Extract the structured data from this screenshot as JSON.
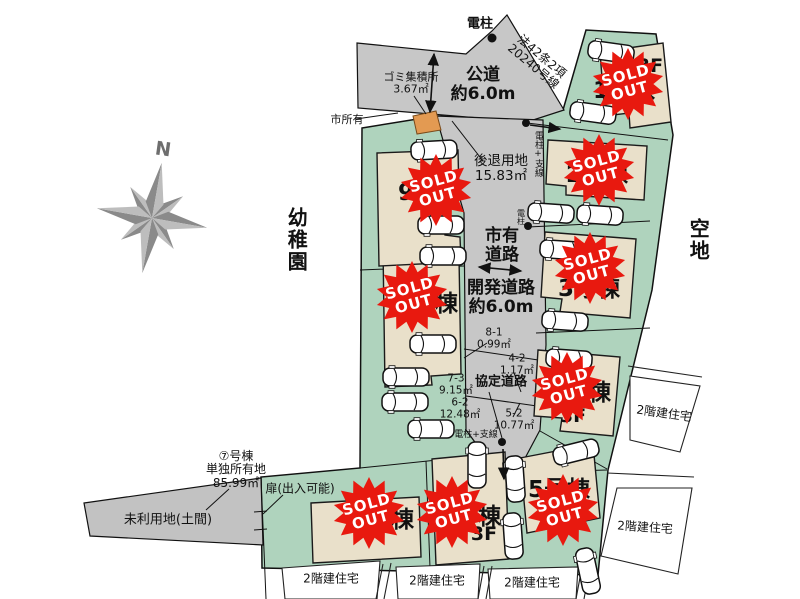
{
  "compass": {
    "north": "N"
  },
  "areas": {
    "kindergarten": "幼稚園",
    "vacant_land": "空地",
    "unused_land": "未利用地(土間)",
    "neighbor_house": "2階建住宅",
    "city_owned": "市所有"
  },
  "roads": {
    "public_road": "公道",
    "public_road_width": "約6.0m",
    "law_line1": "法42条2項",
    "law_line2": "20240号線",
    "city_road_line1": "市有",
    "city_road_line2": "道路",
    "dev_road": "開発道路",
    "dev_road_width": "約6.0m",
    "setback": "後退用地",
    "setback_area": "15.83㎡",
    "agreement_road": "協定道路"
  },
  "features": {
    "utility_pole": "電柱",
    "utility_pole_wire": "電柱+支線",
    "garbage_station": "ゴミ集積所",
    "garbage_area": "3.67㎡",
    "door_note": "扉(出入可能)"
  },
  "sub_parcels": [
    {
      "no": "8-1",
      "area": "0.99㎡"
    },
    {
      "no": "4-2",
      "area": "1.17㎡"
    },
    {
      "no": "7-3",
      "area": "9.15㎡"
    },
    {
      "no": "6-2",
      "area": "12.48㎡"
    },
    {
      "no": "5-2",
      "area": "10.77㎡"
    }
  ],
  "lot7_note": {
    "line1": "⑦号棟",
    "line2": "単独所有地",
    "line3": "85.99㎡"
  },
  "lots": [
    {
      "name": "1号棟",
      "floors": "3F",
      "status": "SOLD OUT"
    },
    {
      "name": "2号棟",
      "floors": "",
      "status": "SOLD OUT"
    },
    {
      "name": "3号棟",
      "floors": "",
      "status": "SOLD OUT"
    },
    {
      "name": "4号棟",
      "floors": "3F",
      "status": "SOLD OUT"
    },
    {
      "name": "5号棟",
      "floors": "",
      "status": "SOLD OUT"
    },
    {
      "name": "6号棟",
      "floors": "3F",
      "status": "SOLD OUT"
    },
    {
      "name": "7号棟",
      "floors": "",
      "status": "SOLD OUT"
    },
    {
      "name": "8号棟",
      "floors": "",
      "status": "SOLD OUT"
    },
    {
      "name": "9号棟",
      "floors": "",
      "status": "SOLD OUT"
    }
  ],
  "badge": {
    "line1": "SOLD",
    "line2": "OUT"
  },
  "colors": {
    "site_green": "#afd3bd",
    "road_gray": "#c7c7c7",
    "building_beige": "#e9e0ca",
    "garbage_orange": "#e39a52",
    "badge_red": "#e8190f"
  }
}
